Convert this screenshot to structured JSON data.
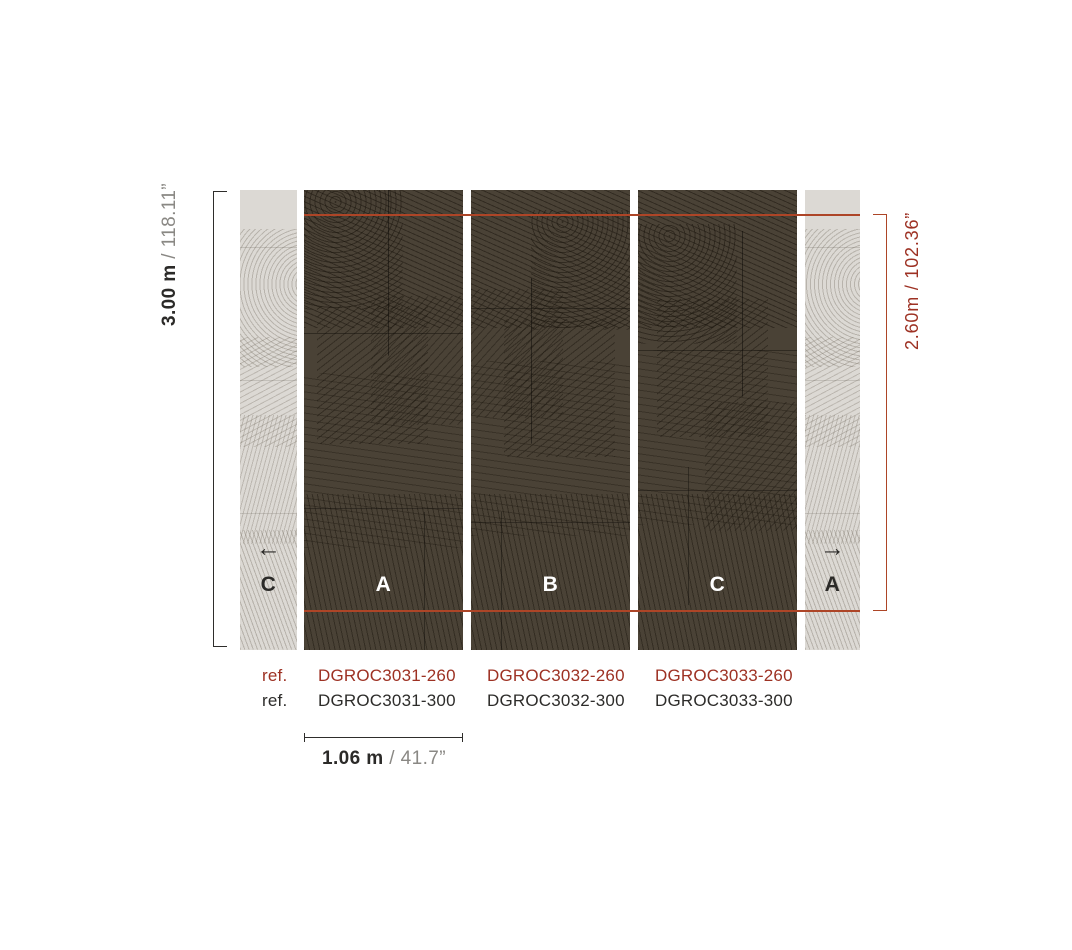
{
  "diagram": {
    "title": "wallpaper panel layout",
    "background": "#ffffff",
    "accent_red": "#9d3123",
    "line_red": "#ad4527",
    "panel_dark_color": "#4a4236",
    "panel_light_color": "#dcd9d4"
  },
  "dimensions": {
    "sep": " / ",
    "total_height": {
      "metric": "3.00 m",
      "imperial": "118.11”"
    },
    "pattern_height": {
      "full": "2.60m / 102.36”"
    },
    "panel_width": {
      "metric": "1.06 m",
      "imperial": "41.7”"
    }
  },
  "panels": {
    "left_partial": {
      "letter": "C",
      "arrow": "←"
    },
    "dark": [
      {
        "letter": "A"
      },
      {
        "letter": "B"
      },
      {
        "letter": "C"
      }
    ],
    "right_partial": {
      "letter": "A",
      "arrow": "→"
    }
  },
  "references": {
    "rows": [
      {
        "label": "ref.",
        "codes": [
          "DGROC3031-260",
          "DGROC3032-260",
          "DGROC3033-260"
        ]
      },
      {
        "label": "ref.",
        "codes": [
          "DGROC3031-300",
          "DGROC3032-300",
          "DGROC3033-300"
        ]
      }
    ]
  }
}
